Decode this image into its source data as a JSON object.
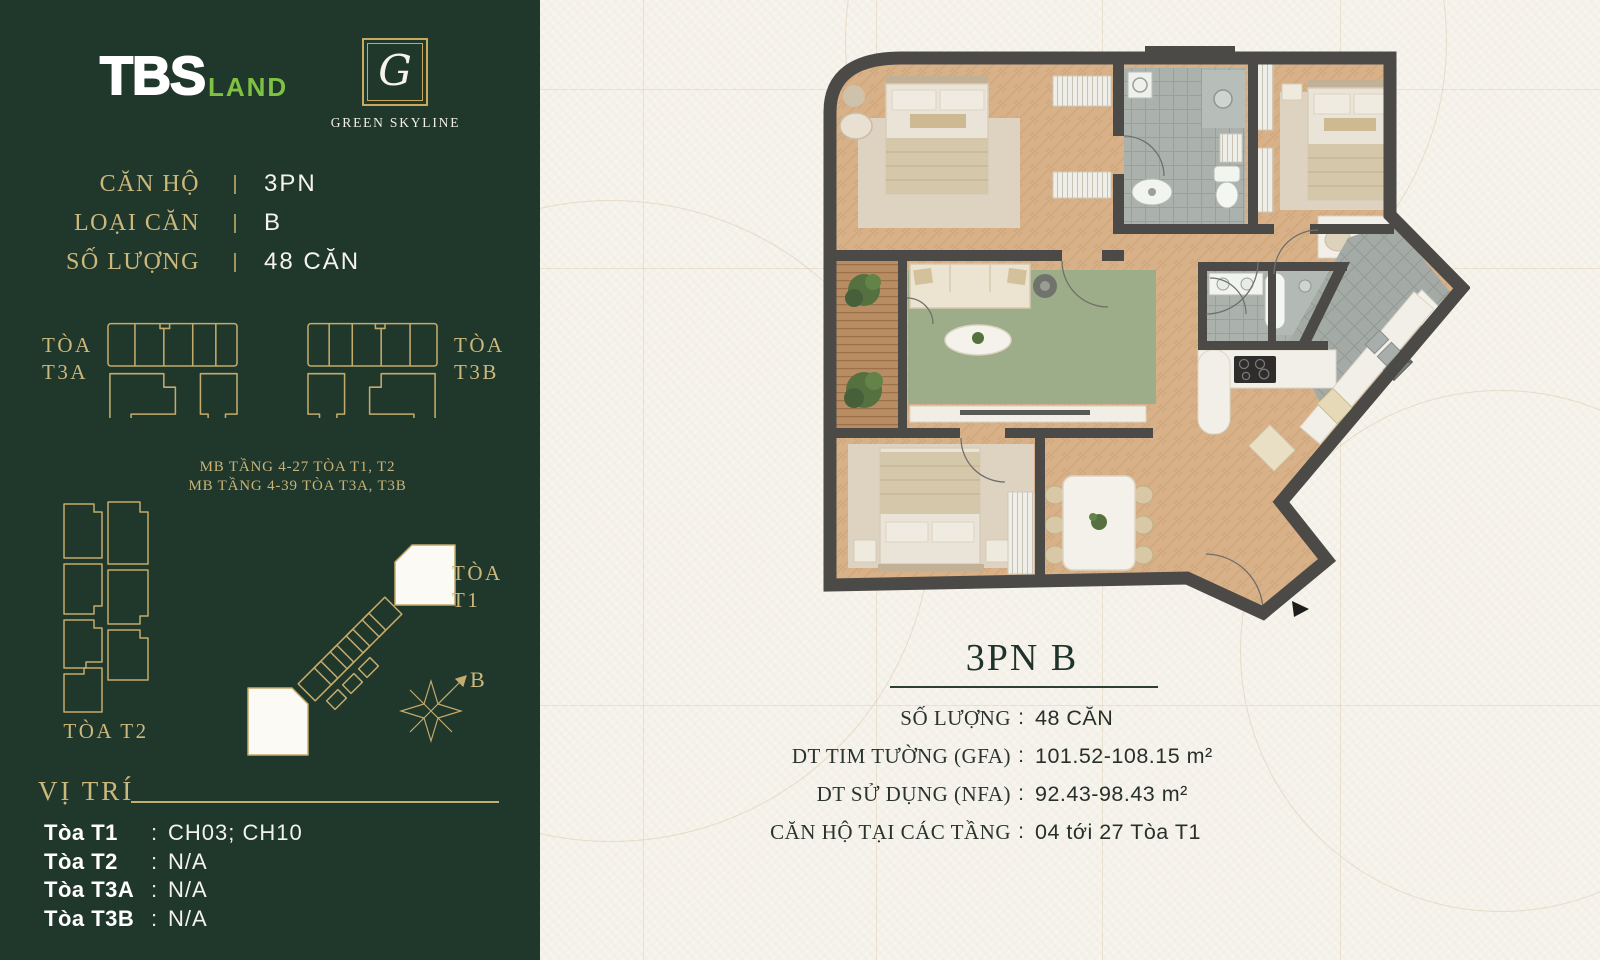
{
  "colors": {
    "sidebar_bg": "#20372c",
    "gold": "#cdb87c",
    "white": "#f4f3ee",
    "brand_green": "#7fc241",
    "paper": "#f6f3ec",
    "ink": "#273029",
    "wall": "#4b4a47",
    "wood_floor": "#d8b189",
    "rug_green": "#9dac89"
  },
  "brand": {
    "tbs_bold": "TBS",
    "tbs_light": "LAND",
    "monogram": "G",
    "project_name": "GREEN SKYLINE"
  },
  "sidebar": {
    "info_rows": [
      {
        "label": "CĂN HỘ",
        "value": "3PN"
      },
      {
        "label": "LOẠI CĂN",
        "value": "B"
      },
      {
        "label": "SỐ LƯỢNG",
        "value": "48 CĂN"
      }
    ],
    "floor_notes": {
      "line1": "MB TẦNG 4-27 TÒA T1, T2",
      "line2": "MB TẦNG 4-39 TÒA T3A, T3B"
    },
    "towers": {
      "t3a": {
        "line1": "TÒA",
        "line2": "T3A"
      },
      "t3b": {
        "line1": "TÒA",
        "line2": "T3B"
      },
      "t1": {
        "line1": "TÒA",
        "line2": "T1"
      },
      "t2_label": "TÒA T2"
    },
    "compass_label": "B",
    "location": {
      "heading": "VỊ TRÍ",
      "separator": ":",
      "rows": [
        {
          "label": "Tòa T1",
          "value": "CH03; CH10"
        },
        {
          "label": "Tòa T2",
          "value": "N/A"
        },
        {
          "label": "Tòa T3A",
          "value": "N/A"
        },
        {
          "label": "Tòa T3B",
          "value": "N/A"
        }
      ]
    }
  },
  "main": {
    "unit_title": "3PN B",
    "separator": ":",
    "specs": [
      {
        "label": "SỐ LƯỢNG",
        "value": "48 CĂN"
      },
      {
        "label": "DT TIM TƯỜNG (GFA)",
        "value": "101.52-108.15 m²"
      },
      {
        "label": "DT SỬ DỤNG (NFA)",
        "value": "92.43-98.43 m²"
      },
      {
        "label": "CĂN HỘ TẠI CÁC TẦNG",
        "value": "04 tới 27 Tòa T1"
      }
    ]
  }
}
